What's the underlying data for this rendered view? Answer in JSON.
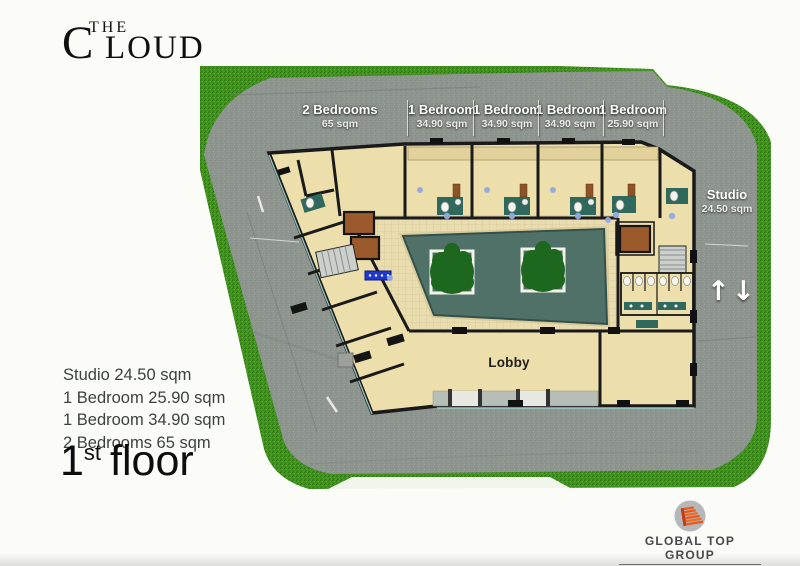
{
  "logo": {
    "top_word": "THE",
    "initial": "C",
    "rest": "LOUD"
  },
  "plan_labels": {
    "units": [
      {
        "name": "2 Bedrooms",
        "area": "65 sqm"
      },
      {
        "name": "1 Bedroom",
        "area": "34.90 sqm"
      },
      {
        "name": "1 Bedroom",
        "area": "34.90 sqm"
      },
      {
        "name": "1 Bedroom",
        "area": "34.90 sqm"
      },
      {
        "name": "1 Bedroom",
        "area": "25.90 sqm"
      }
    ],
    "studio": {
      "name": "Studio",
      "area": "24.50 sqm"
    },
    "lobby": "Lobby",
    "up_arrow": "↑",
    "down_arrow": "↓"
  },
  "legend": {
    "items": [
      "Studio 24.50 sqm",
      "1 Bedroom 25.90 sqm",
      "1 Bedroom 34.90 sqm",
      "2 Bedrooms 65 sqm"
    ]
  },
  "floor_title": {
    "number": "1",
    "ordinal": "st",
    "word": "floor"
  },
  "brand": {
    "name": "GLOBAL TOP GROUP",
    "tagline": "DELIVERING OUTSTANDING DEVELOPMENTS"
  },
  "colors": {
    "road": "#8e948e",
    "grass": "#3f921c",
    "room": "#eddfac",
    "tile": "#e9ddb0",
    "pool": "#507168",
    "tree": "#1e671e",
    "wall": "#1a1a1a",
    "elevator": "#9a5a2c",
    "fixture_teal": "#2f685d",
    "brand_orange": "#e85b1e"
  }
}
